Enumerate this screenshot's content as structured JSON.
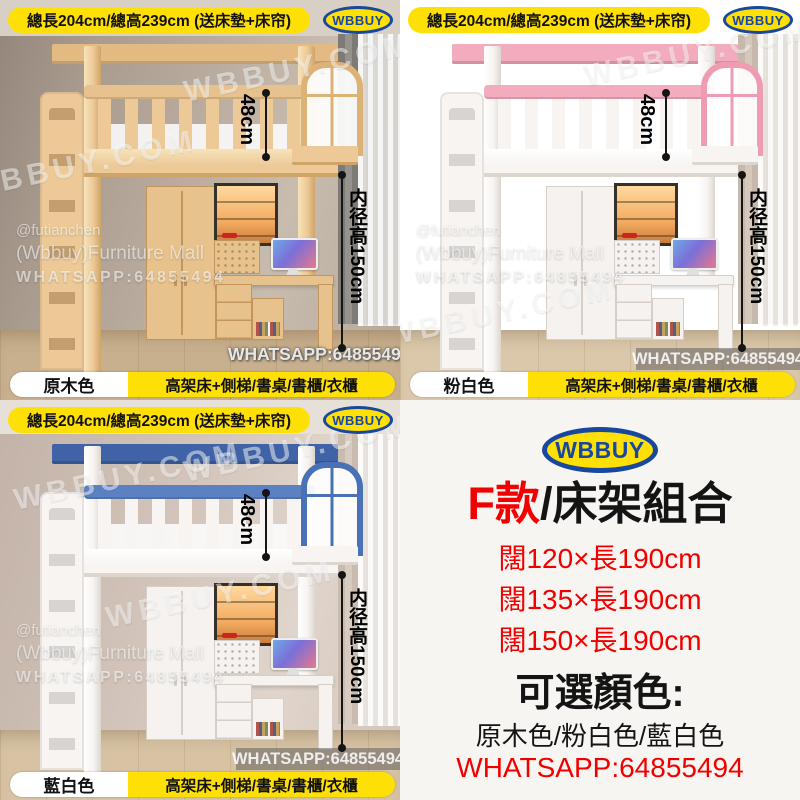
{
  "brand": {
    "logo_text": "WBBUY",
    "logo_blue": "#17479e",
    "logo_yellow": "#ffe006"
  },
  "shared": {
    "banner": "總長204cm/總高239cm (送床墊+床帘)",
    "features": "高架床+側梯/書桌/書櫃/衣櫃",
    "measure_rail": "48cm",
    "measure_inner": "内径高150cm",
    "banner_yellow": "#ffe006"
  },
  "watermarks": {
    "site": "WBBUY.COM",
    "handle": "@futianchen",
    "store": "(Wbbuy)Furniture Mall",
    "whatsapp": "WHATSAPP:64855494"
  },
  "quadrants": [
    {
      "name": "natural-wood",
      "color_label": "原木色",
      "accent": "#e7c28e"
    },
    {
      "name": "pink-white",
      "color_label": "粉白色",
      "accent": "#f3abbe"
    },
    {
      "name": "blue-white",
      "color_label": "藍白色",
      "accent": "#4a70b5"
    }
  ],
  "info_panel": {
    "logo_text": "WBBUY",
    "model_red": "F款",
    "model_rest": "/床架組合",
    "sizes": [
      "闊120×長190cm",
      "闊135×長190cm",
      "闊150×長190cm"
    ],
    "colors_heading": "可選顏色:",
    "colors_list": "原木色/粉白色/藍白色",
    "whatsapp": "WHATSAPP:64855494",
    "red": "#f20000"
  }
}
